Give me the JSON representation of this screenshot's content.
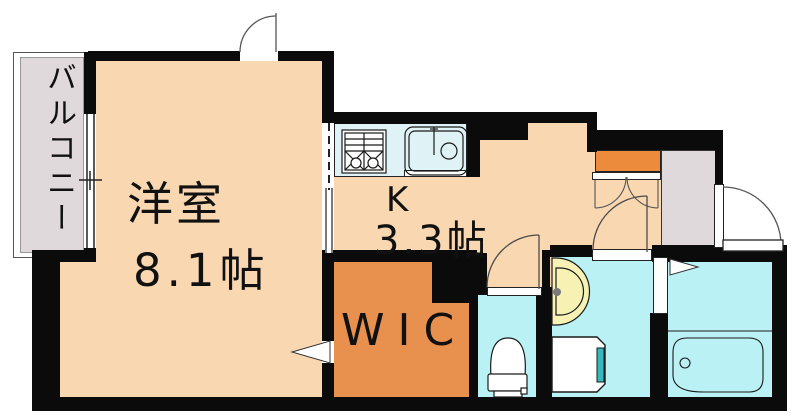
{
  "floorplan": {
    "type": "apartment-floor-plan",
    "rooms": {
      "balcony": {
        "label": "バルコニー"
      },
      "living": {
        "name": "洋室",
        "size": "8.1帖"
      },
      "kitchen": {
        "name": "K",
        "size": "3.3帖"
      },
      "wic": {
        "label": "WIC"
      }
    },
    "colors": {
      "room_floor": "#F9D8B1",
      "wic_floor": "#E8914E",
      "shoe_cabinet": "#ED8B3D",
      "wet_area": "#B9F1F5",
      "kitchen_counter": "#DFF3F7",
      "vanity": "#F7F2B4",
      "washer_accent": "#35B9BE",
      "balcony_gray": "#DFD9DB",
      "wall": "#0B0B0B"
    },
    "fixtures": [
      "stove-icon",
      "sink-icon",
      "vanity-icon",
      "toilet-icon",
      "washer-icon",
      "bathtub-icon",
      "window-icon",
      "door-swing-icon"
    ]
  }
}
